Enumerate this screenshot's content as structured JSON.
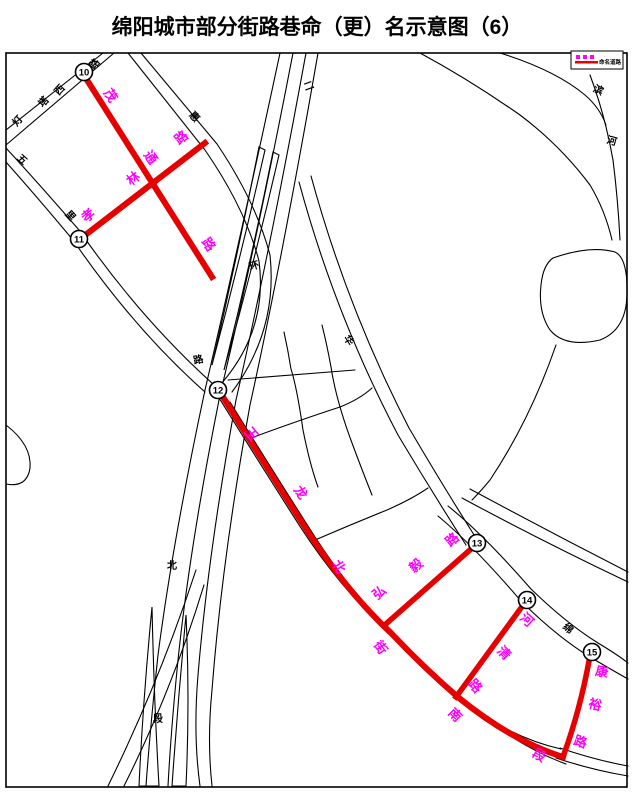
{
  "title": "绵阳城市部分街路巷命（更）名示意图（6）",
  "legend": {
    "label": "命名道路"
  },
  "colors": {
    "highlight_red": "#e60000",
    "label_magenta": "#ff00ff",
    "road_black": "#000000",
    "background": "#ffffff"
  },
  "map": {
    "junctions": [
      {
        "number": "10",
        "x": 84,
        "y": 72
      },
      {
        "number": "11",
        "x": 79,
        "y": 239
      },
      {
        "number": "12",
        "x": 218,
        "y": 390
      },
      {
        "number": "13",
        "x": 477,
        "y": 543
      },
      {
        "number": "14",
        "x": 527,
        "y": 600
      },
      {
        "number": "15",
        "x": 592,
        "y": 652
      }
    ],
    "road_labels": [
      {
        "id": "maotong-road",
        "name": "茂通路",
        "color": "#ff00ff",
        "size": 13,
        "chars": [
          {
            "c": "茂",
            "x": 107,
            "y": 98,
            "r": 55
          },
          {
            "c": "通",
            "x": 147,
            "y": 160,
            "r": 55
          },
          {
            "c": "路",
            "x": 205,
            "y": 247,
            "r": 55
          }
        ]
      },
      {
        "id": "xiaolin-road",
        "name": "孝林路",
        "color": "#ff00ff",
        "size": 13,
        "chars": [
          {
            "c": "孝",
            "x": 91,
            "y": 219,
            "r": -38
          },
          {
            "c": "林",
            "x": 136,
            "y": 182,
            "r": -38
          },
          {
            "c": "路",
            "x": 184,
            "y": 141,
            "r": -38
          }
        ]
      },
      {
        "id": "yulong-north-street",
        "name": "玉龙北街南段",
        "color": "#ff00ff",
        "size": 13,
        "chars": [
          {
            "c": "玉",
            "x": 248,
            "y": 437,
            "r": 50
          },
          {
            "c": "龙",
            "x": 297,
            "y": 495,
            "r": 55
          },
          {
            "c": "北",
            "x": 335,
            "y": 569,
            "r": 58
          },
          {
            "c": "街",
            "x": 377,
            "y": 650,
            "r": 55
          },
          {
            "c": "南",
            "x": 452,
            "y": 718,
            "r": 45
          },
          {
            "c": "段",
            "x": 537,
            "y": 759,
            "r": 30
          }
        ]
      },
      {
        "id": "hongyi-road",
        "name": "弘毅路",
        "color": "#ff00ff",
        "size": 13,
        "chars": [
          {
            "c": "弘",
            "x": 382,
            "y": 596,
            "r": -40
          },
          {
            "c": "毅",
            "x": 419,
            "y": 569,
            "r": -40
          },
          {
            "c": "路",
            "x": 455,
            "y": 543,
            "r": -40
          }
        ]
      },
      {
        "id": "heqing-road",
        "name": "河清路",
        "color": "#ff00ff",
        "size": 13,
        "chars": [
          {
            "c": "河",
            "x": 524,
            "y": 623,
            "r": 42
          },
          {
            "c": "清",
            "x": 501,
            "y": 656,
            "r": 45
          },
          {
            "c": "路",
            "x": 472,
            "y": 689,
            "r": 48
          }
        ]
      },
      {
        "id": "kangyu-road",
        "name": "康裕路",
        "color": "#ff00ff",
        "size": 13,
        "chars": [
          {
            "c": "康",
            "x": 601,
            "y": 676,
            "r": 12
          },
          {
            "c": "裕",
            "x": 594,
            "y": 709,
            "r": 14
          },
          {
            "c": "路",
            "x": 579,
            "y": 746,
            "r": 18
          }
        ]
      },
      {
        "id": "dengta-west-road",
        "name": "灯塔西路",
        "color": "#000000",
        "size": 10,
        "chars": [
          {
            "c": "灯",
            "x": 20,
            "y": 123,
            "r": -48
          },
          {
            "c": "塔",
            "x": 46,
            "y": 104,
            "r": -48
          },
          {
            "c": "西",
            "x": 62,
            "y": 92,
            "r": -48
          },
          {
            "c": "路",
            "x": 97,
            "y": 66,
            "r": -48
          }
        ]
      },
      {
        "id": "hui-road",
        "name": "惠",
        "color": "#000000",
        "size": 10,
        "chars": [
          {
            "c": "惠",
            "x": 192,
            "y": 119,
            "r": 48
          }
        ]
      },
      {
        "id": "wuli-road",
        "name": "五里",
        "color": "#000000",
        "size": 10,
        "chars": [
          {
            "c": "五",
            "x": 20,
            "y": 162,
            "r": 42
          },
          {
            "c": "里",
            "x": 68,
            "y": 218,
            "r": 48
          }
        ]
      },
      {
        "id": "second-ring-road-north",
        "name": "二环路北段",
        "color": "#000000",
        "size": 10,
        "chars": [
          {
            "c": "二",
            "x": 310,
            "y": 89,
            "r": -20
          },
          {
            "c": "环",
            "x": 255,
            "y": 269,
            "r": -15
          },
          {
            "c": "路",
            "x": 199,
            "y": 363,
            "r": -12
          },
          {
            "c": "北",
            "x": 172,
            "y": 569,
            "r": 0
          },
          {
            "c": "段",
            "x": 158,
            "y": 722,
            "r": 0
          }
        ]
      },
      {
        "id": "hua-road",
        "name": "华",
        "color": "#000000",
        "size": 10,
        "chars": [
          {
            "c": "华",
            "x": 346,
            "y": 342,
            "r": 58
          }
        ]
      },
      {
        "id": "mian-road",
        "name": "绵",
        "color": "#000000",
        "size": 10,
        "chars": [
          {
            "c": "绵",
            "x": 566,
            "y": 631,
            "r": 40
          }
        ]
      },
      {
        "id": "binhe-road",
        "name": "滨河",
        "color": "#000000",
        "size": 10,
        "chars": [
          {
            "c": "滨",
            "x": 597,
            "y": 93,
            "r": 25
          },
          {
            "c": "河",
            "x": 611,
            "y": 144,
            "r": 15
          }
        ]
      }
    ]
  }
}
